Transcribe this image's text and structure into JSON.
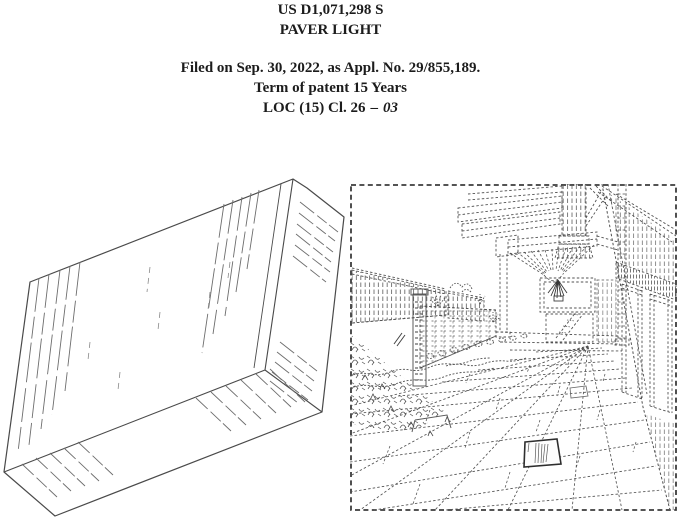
{
  "header": {
    "patent_number": "US D1,071,298 S",
    "title": "PAVER LIGHT",
    "filed_line": "Filed on Sep. 30, 2022, as Appl. No. 29/855,189.",
    "term_line": "Term of patent 15 Years",
    "loc_prefix": "LOC (15) Cl. 26",
    "loc_separator": "–",
    "loc_class": "03"
  },
  "colors": {
    "ink": "#3a3a3a",
    "line_gray": "#555555",
    "paper": "#ffffff"
  }
}
